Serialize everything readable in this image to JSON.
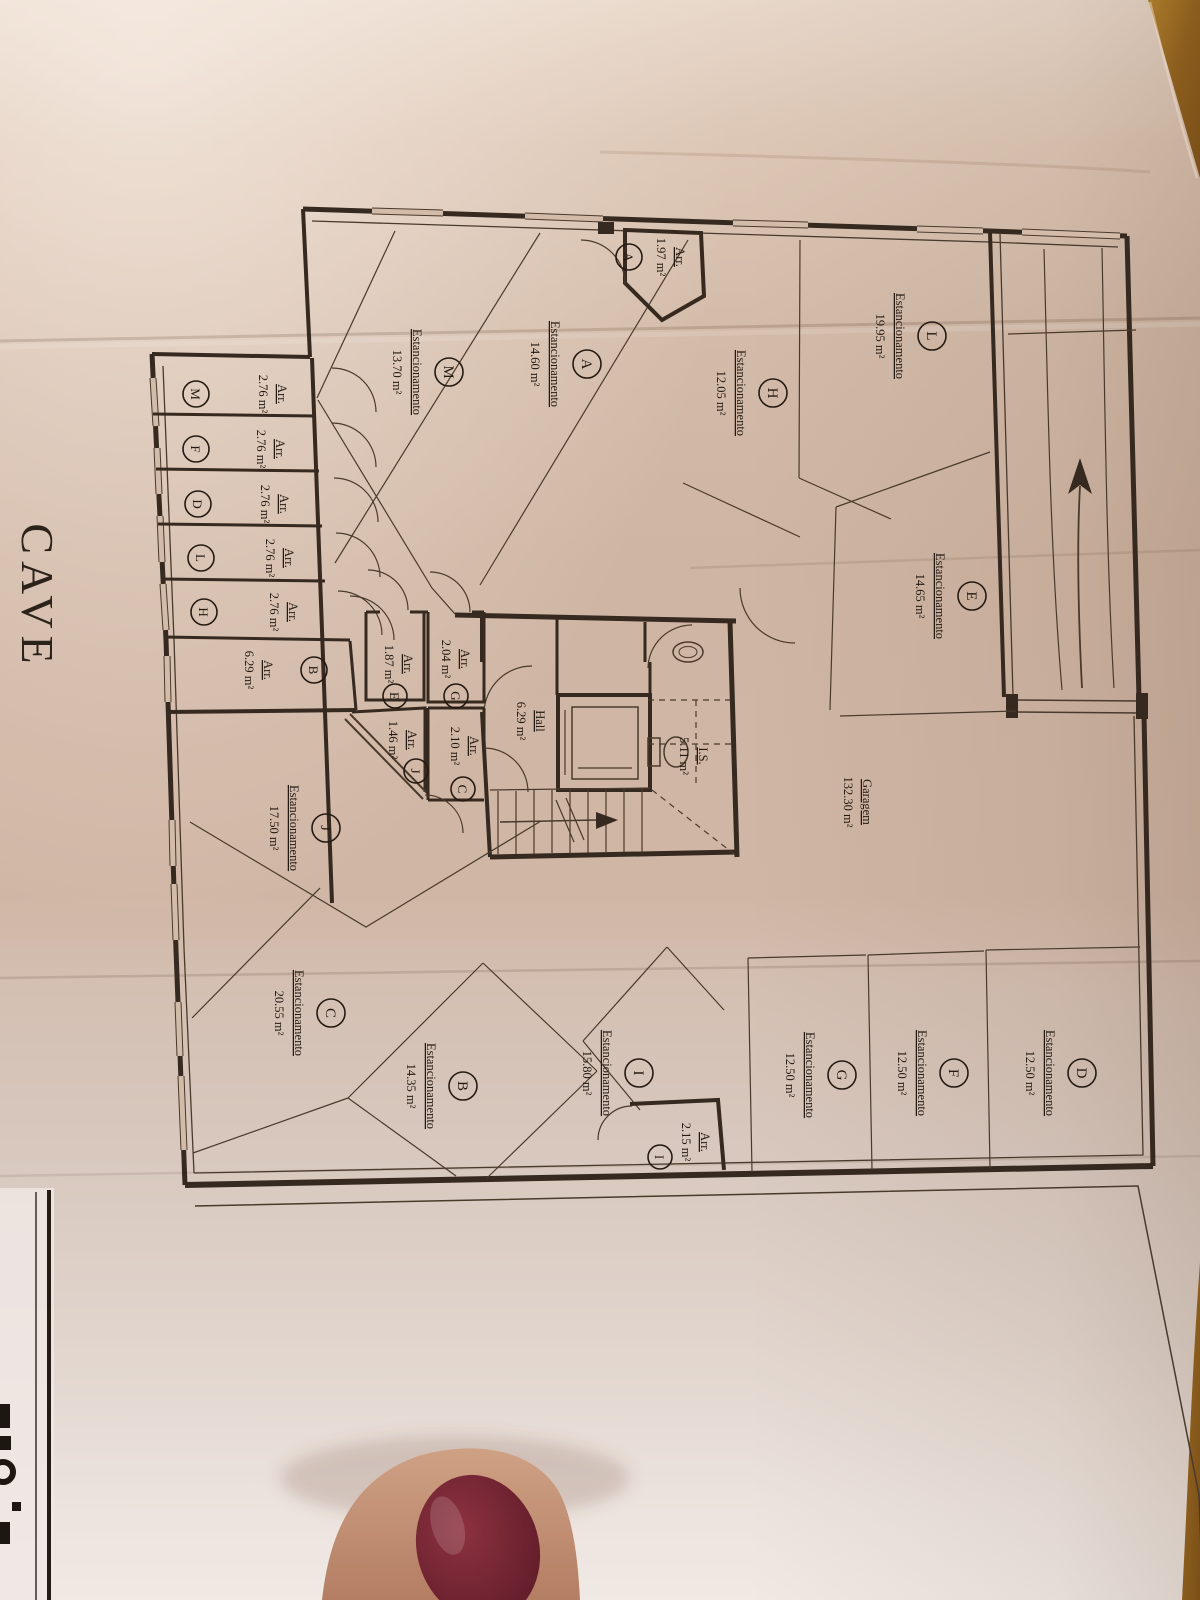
{
  "plan": {
    "title": "CAVE",
    "labels": {
      "parking": "Estancionamento",
      "storage": "Arr.",
      "garage": "Garagem",
      "hall": "Hall",
      "wc": "I.S."
    },
    "garage_area": "132.30 m²",
    "hall_area": "6.29 m²",
    "wc_area": "5.11 m²",
    "parking_spaces": [
      {
        "letter": "L",
        "area": "19.95 m²"
      },
      {
        "letter": "H",
        "area": "12.05 m²"
      },
      {
        "letter": "A",
        "area": "14.60 m²"
      },
      {
        "letter": "M",
        "area": "13.70 m²"
      },
      {
        "letter": "E",
        "area": "14.65 m²"
      },
      {
        "letter": "J",
        "area": "17.50 m²"
      },
      {
        "letter": "C",
        "area": "20.55 m²"
      },
      {
        "letter": "B",
        "area": "14.35 m²"
      },
      {
        "letter": "I",
        "area": "15.80 m²"
      },
      {
        "letter": "G",
        "area": "12.50 m²"
      },
      {
        "letter": "F",
        "area": "12.50 m²"
      },
      {
        "letter": "D",
        "area": "12.50 m²"
      }
    ],
    "storage_rooms": [
      {
        "letter": "A",
        "area": "1.97 m²"
      },
      {
        "letter": "M",
        "area": "2.76 m²"
      },
      {
        "letter": "F",
        "area": "2.76 m²"
      },
      {
        "letter": "D",
        "area": "2.76 m²"
      },
      {
        "letter": "L",
        "area": "2.76 m²"
      },
      {
        "letter": "H",
        "area": "2.76 m²"
      },
      {
        "letter": "B",
        "area": "6.29 m²"
      },
      {
        "letter": "E",
        "area": "1.87 m²"
      },
      {
        "letter": "G",
        "area": "2.04 m²"
      },
      {
        "letter": "J",
        "area": "1.46 m²"
      },
      {
        "letter": "C",
        "area": "2.10 m²"
      },
      {
        "letter": "I",
        "area": "2.15 m²"
      }
    ]
  },
  "colors": {
    "ink": "#36291f",
    "paper": "#d0b6a5",
    "wood": "#96671f",
    "nail_polish": "#6d2230",
    "skin": "#c49076"
  }
}
